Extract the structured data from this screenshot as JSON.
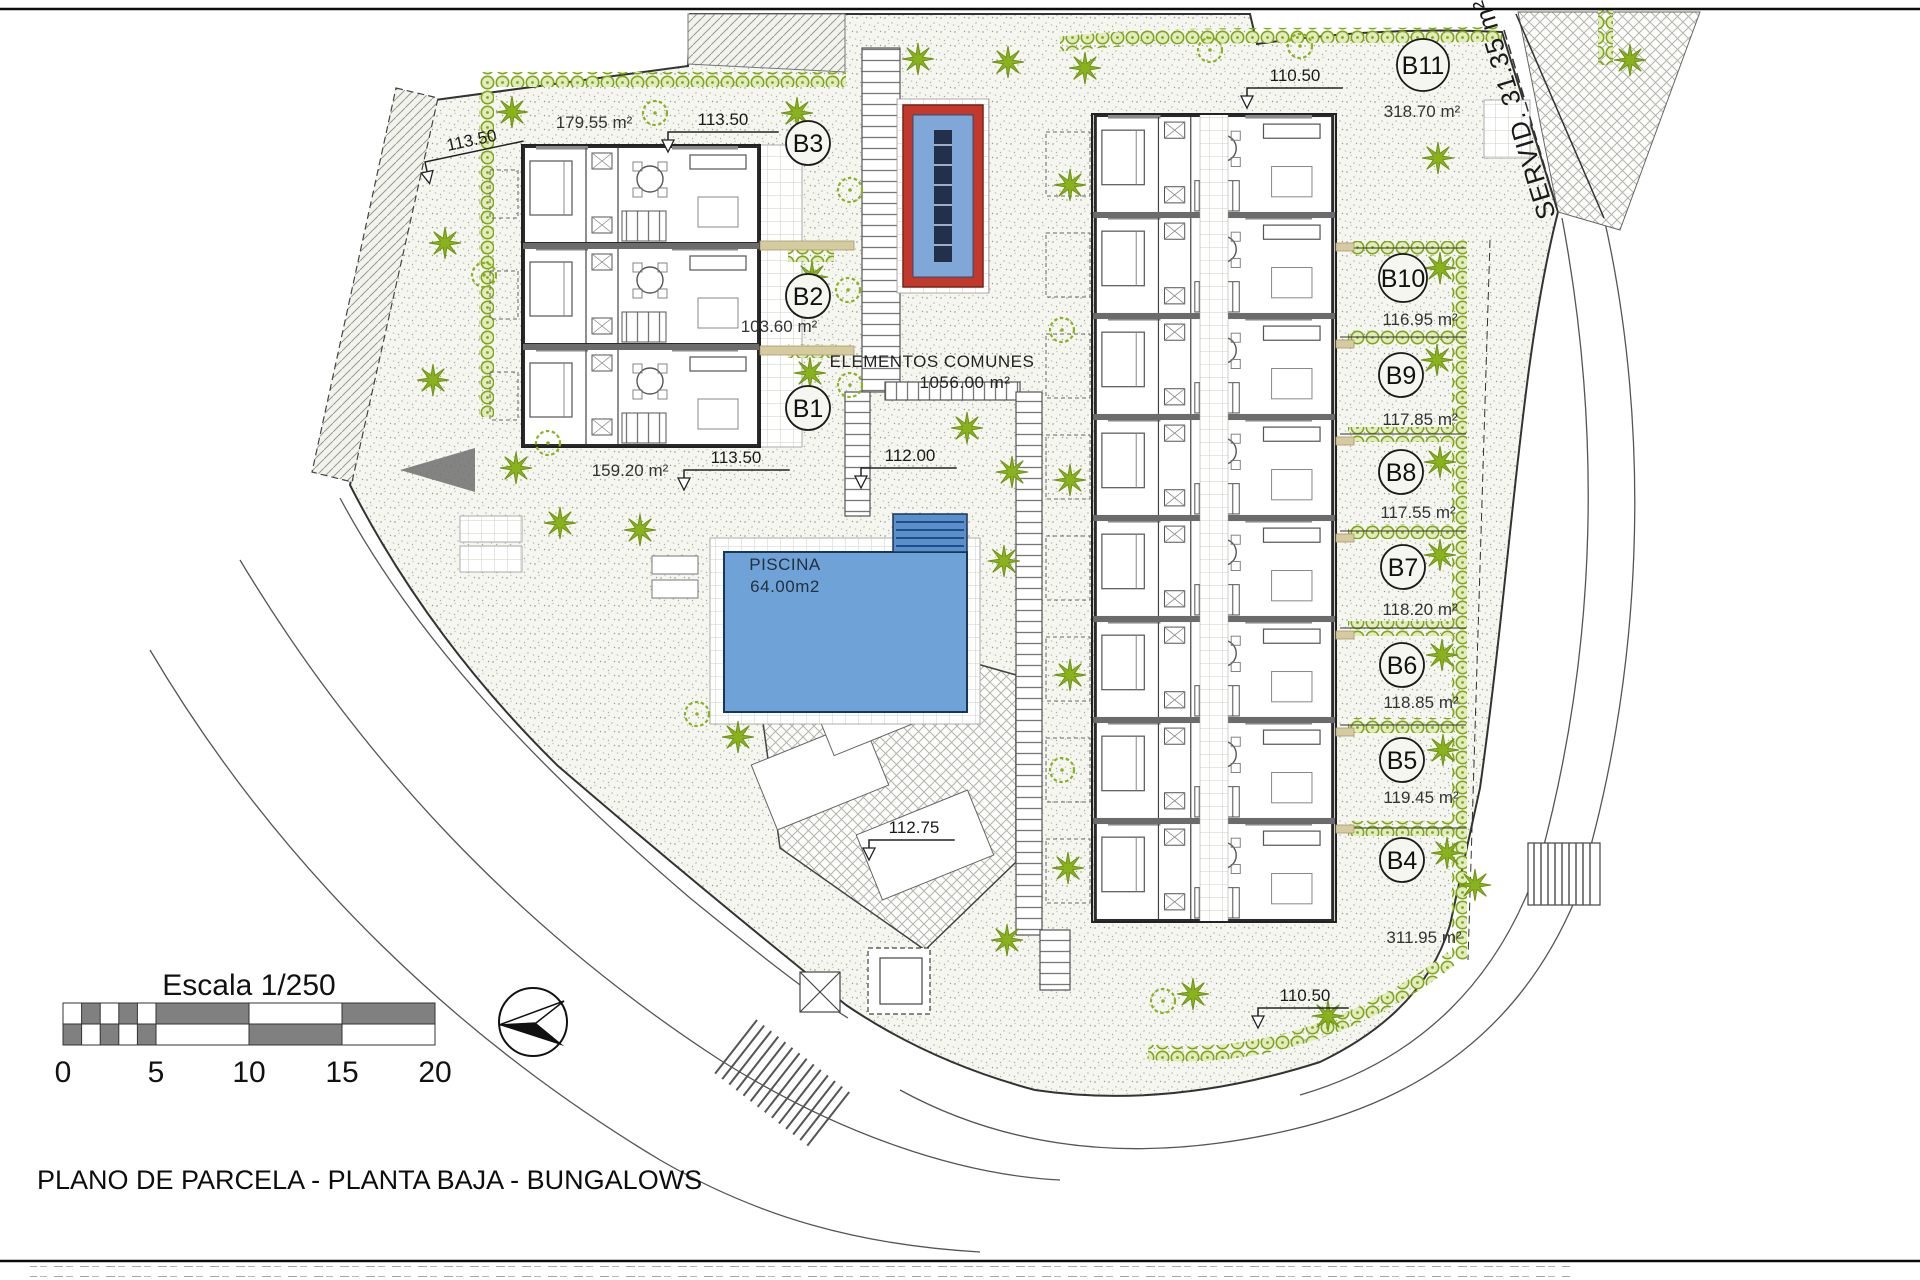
{
  "title": "PLANO DE PARCELA - PLANTA BAJA - BUNGALOWS",
  "scale_bar": {
    "label": "Escala 1/250",
    "ticks": [
      "0",
      "5",
      "10",
      "15",
      "20"
    ]
  },
  "common_area": {
    "name": "ELEMENTOS COMUNES",
    "area": "1056.00 m²"
  },
  "pool": {
    "name": "PISCINA",
    "area": "64.00m2"
  },
  "easement": {
    "label": "SERVID. 31.35 m²"
  },
  "plots": [
    {
      "id": "B1",
      "area": "159.20 m²"
    },
    {
      "id": "B2",
      "area": "103.60 m²"
    },
    {
      "id": "B3",
      "area": "179.55 m²"
    },
    {
      "id": "B4",
      "area": "311.95 m²"
    },
    {
      "id": "B5",
      "area": "119.45 m²"
    },
    {
      "id": "B6",
      "area": "118.85 m²"
    },
    {
      "id": "B7",
      "area": "118.20 m²"
    },
    {
      "id": "B8",
      "area": "117.55 m²"
    },
    {
      "id": "B9",
      "area": "117.85 m²"
    },
    {
      "id": "B10",
      "area": "116.95 m²"
    },
    {
      "id": "B11",
      "area": "318.70 m²"
    }
  ],
  "level_marks": [
    {
      "value": "113.50",
      "loc": "left-edge"
    },
    {
      "value": "113.50",
      "loc": "top-garden"
    },
    {
      "value": "113.50",
      "loc": "below-left-block"
    },
    {
      "value": "112.00",
      "loc": "center-walk"
    },
    {
      "value": "112.75",
      "loc": "central-plaza"
    },
    {
      "value": "110.50",
      "loc": "plot-b11"
    },
    {
      "value": "110.50",
      "loc": "bottom-right-garden"
    }
  ],
  "colors": {
    "pool_blue": "#6fa3d7",
    "pool_dark": "#1d4f8a",
    "spa_red": "#c0392b",
    "vegetation_green": "#8ab21f",
    "hedge_fill": "#e3edbc",
    "wall_dark": "#2b2b2b",
    "gravel_dot": "#aaaa9b"
  }
}
